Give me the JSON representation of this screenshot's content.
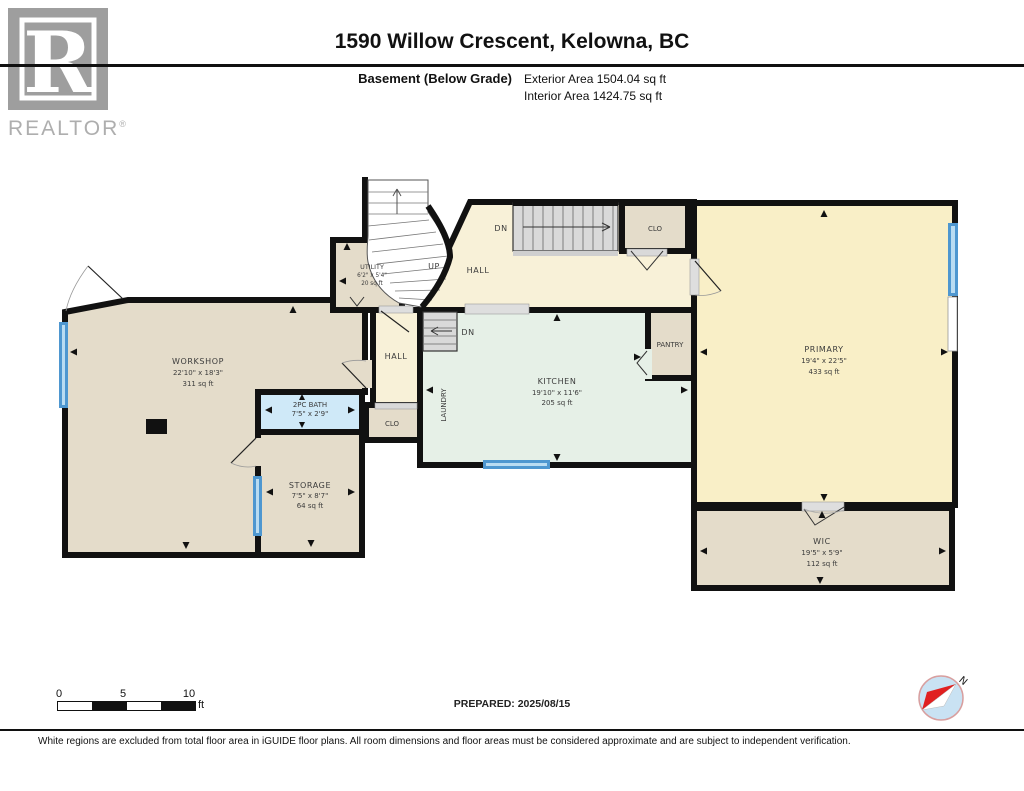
{
  "header": {
    "logo": {
      "letter": "R",
      "brand": "REALTOR",
      "registered": "®"
    },
    "title": "1590 Willow Crescent, Kelowna, BC",
    "floor_label": "Basement (Below Grade)",
    "exterior_area": "Exterior Area 1504.04 sq ft",
    "interior_area": "Interior Area 1424.75 sq ft"
  },
  "rooms": {
    "workshop": {
      "name": "WORKSHOP",
      "dims": "22'10\" x 18'3\"",
      "area": "311 sq ft"
    },
    "bath": {
      "name": "2PC BATH",
      "dims": "7'5\" x 2'9\""
    },
    "storage": {
      "name": "STORAGE",
      "dims": "7'5\" x 8'7\"",
      "area": "64 sq ft"
    },
    "hall_lower": {
      "name": "HALL"
    },
    "clo_lower": {
      "name": "CLO"
    },
    "utility": {
      "name": "UTILITY",
      "dims": "6'2\" x 5'4\"",
      "area": "20 sq ft"
    },
    "hall_upper": {
      "name": "HALL"
    },
    "clo_upper": {
      "name": "CLO"
    },
    "kitchen": {
      "name": "KITCHEN",
      "dims": "19'10\" x 11'6\"",
      "area": "205 sq ft"
    },
    "laundry": {
      "name": "LAUNDRY"
    },
    "pantry": {
      "name": "PANTRY"
    },
    "primary": {
      "name": "PRIMARY",
      "dims": "19'4\" x 22'5\"",
      "area": "433 sq ft"
    },
    "wic": {
      "name": "WIC",
      "dims": "19'5\" x 5'9\"",
      "area": "112 sq ft"
    }
  },
  "stairs": {
    "up_label": "UP",
    "down_upper_label": "DN",
    "down_lower_label": "DN"
  },
  "footer": {
    "scale": {
      "tick0": "0",
      "tick5": "5",
      "tick10": "10",
      "unit": "ft"
    },
    "prepared": "PREPARED: 2025/08/15",
    "compass_north": "N",
    "disclaimer": "White regions are excluded from total floor area in iGUIDE floor plans. All room dimensions and floor areas must be considered approximate and are subject to independent verification."
  },
  "colors": {
    "wall": "#111111",
    "tan_room": "#e4dcca",
    "cream_hall": "#f8f1d8",
    "mint_kitchen": "#e6f0e7",
    "yellow_primary": "#f9efc7",
    "bath_blue": "#cfe9f8",
    "window_blue": "#4e97d0",
    "stair_gray": "#d9d9d9"
  }
}
